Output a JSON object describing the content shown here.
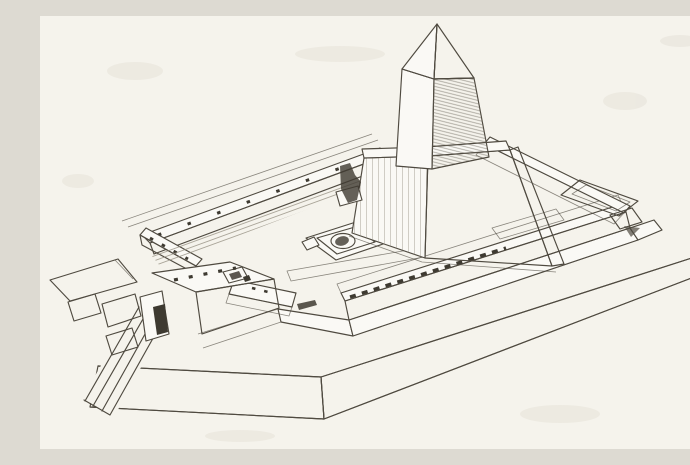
{
  "scene": {
    "type": "engraving-illustration",
    "description": "Black-and-white engraving: bird's-eye reconstruction of an ancient Egyptian sun temple. A rectangular walled court sits on a raised desert terrace; inside stands a massive obelisk on a sloping truncated-pyramid pedestal, with a round altar in the courtyard. An entrance gatehouse at the front left connects to a long causeway ramp running down the terrace, and a flat rectangular annex outline lies beside the right wall.",
    "elements": {
      "obelisk": "Obelisk with pyramidion tip",
      "pedestal": "Truncated-pyramid obelisk pedestal",
      "altar": "Round alabaster altar in the courtyard",
      "enclosure_wall": "Rectangular enclosure wall with parapet",
      "basin_row": "Row of dark basins on the front wall top",
      "gatehouse": "Entrance gatehouse pavilion",
      "causeway": "Causeway ramp descending the terrace",
      "walkway": "Walkway linking gatehouse and front wall",
      "annex": "Flat rectangular annex outline",
      "terrace": "Raised desert terrace podium",
      "statue": "Small guardian figure at the pedestal corner"
    }
  },
  "palette": {
    "paper": "#f5f3ec",
    "paper2": "#faf9f5",
    "ink": "#4f4a40",
    "ink2": "#3e3a31",
    "mid": "#6e695e",
    "lighth": "#928c7e",
    "smudge": "#e7e4da"
  }
}
